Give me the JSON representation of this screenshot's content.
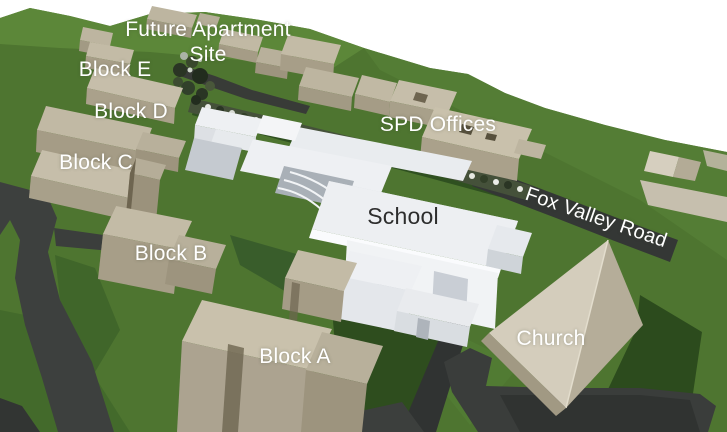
{
  "labels": {
    "future_site_line1": "Future Apartment",
    "future_site_line2": "Site",
    "block_e": "Block E",
    "block_d": "Block D",
    "block_c": "Block C",
    "block_b": "Block B",
    "block_a": "Block A",
    "spd_offices": "SPD Offices",
    "school": "School",
    "church": "Church",
    "road": "Fox Valley Road"
  },
  "colors": {
    "sky": "#ffffff",
    "grass": "#4e7530",
    "grass_light": "#5e8a3b",
    "grass_dark_shadow": "#2c4b1d",
    "road": "#3b3e3c",
    "building_tan_roof": "#c6beaa",
    "building_tan_front": "#a59c86",
    "building_tan_side": "#80775f",
    "school_white": "#eef0f3",
    "church_roof_light": "#d4cdbc",
    "church_roof_dark": "#b5ad99",
    "label_white": "#ffffff",
    "label_dark": "#2d2d2d"
  }
}
